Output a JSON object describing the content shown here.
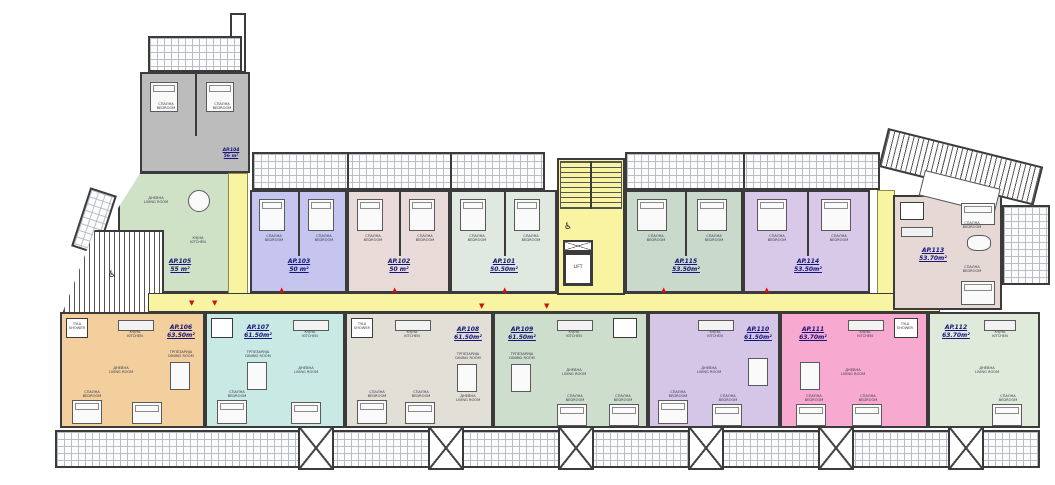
{
  "plan_title": "Residential floor plan — first floor apartments",
  "apartments": [
    {
      "id": "AP.104",
      "area": "56 m²",
      "color": "#bcbcbc"
    },
    {
      "id": "AP.105",
      "area": "55 m²",
      "color": "#cfe2c6"
    },
    {
      "id": "AP.103",
      "area": "50 m²",
      "color": "#c5c5ef"
    },
    {
      "id": "AP.102",
      "area": "50 m²",
      "color": "#e9dcd8"
    },
    {
      "id": "AP.101",
      "area": "50.50m²",
      "color": "#dfe9df"
    },
    {
      "id": "AP.115",
      "area": "53.50m²",
      "color": "#c9dacd"
    },
    {
      "id": "AP.114",
      "area": "53.50m²",
      "color": "#d9c9e9"
    },
    {
      "id": "AP.113",
      "area": "53.70m²",
      "color": "#e6d9d5"
    },
    {
      "id": "AP.106",
      "area": "63.50m²",
      "color": "#f2cf9d"
    },
    {
      "id": "AP.107",
      "area": "61.50m²",
      "color": "#c8e9e4"
    },
    {
      "id": "AP.108",
      "area": "61.50m²",
      "color": "#e2dfd6"
    },
    {
      "id": "AP.109",
      "area": "61.50m²",
      "color": "#cedecd"
    },
    {
      "id": "AP.110",
      "area": "61.50m²",
      "color": "#d5c5e6"
    },
    {
      "id": "AP.111",
      "area": "63.70m²",
      "color": "#f8a9d0"
    },
    {
      "id": "AP.112",
      "area": "63.70m²",
      "color": "#dfeadb"
    }
  ],
  "rooms": {
    "bedroom": "СПАЛНА\nBEDROOM",
    "kitchen": "КУЈНА\nKITCHEN",
    "dining": "ТРПЕЗАРИЈА\nDINING ROOM",
    "living": "ДНЕВНА\nLIVING ROOM",
    "shower": "ТУШ\nSHOWER"
  },
  "core": {
    "lift": "LIFT",
    "accessible_symbol": "♿"
  },
  "markers": {
    "up": "▲",
    "down": "▼"
  },
  "colors": {
    "corridor": "#f8f4a2",
    "wall": "#3b3b3b",
    "marker": "#cc1111",
    "label_text": "#14147a"
  }
}
